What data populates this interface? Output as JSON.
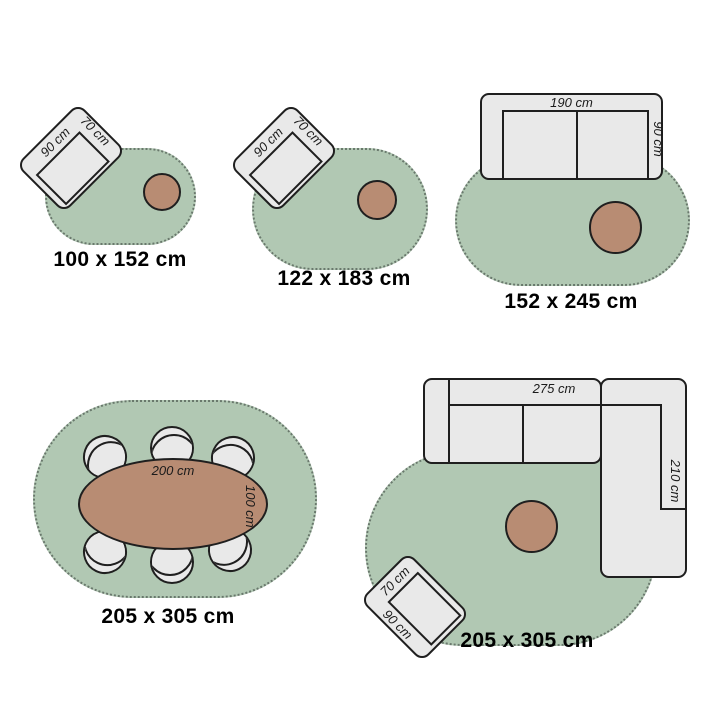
{
  "title": "rug size comparison diagram",
  "colors": {
    "rug": "#b1c8b3",
    "furniture": "#e9e9e9",
    "accent": "#b88c73",
    "outline": "#1f1f1f"
  },
  "scenes": [
    {
      "name": "oval-rug-small",
      "size_label": "100 x 152 cm",
      "chair": {
        "width": "90 cm",
        "depth": "70 cm"
      }
    },
    {
      "name": "oval-rug-medium",
      "size_label": "122 x 183 cm",
      "chair": {
        "width": "90 cm",
        "depth": "70 cm"
      }
    },
    {
      "name": "oval-rug-large",
      "size_label": "152 x 245 cm",
      "sofa": {
        "width": "190 cm",
        "depth": "90 cm"
      }
    },
    {
      "name": "oval-rug-dining",
      "size_label": "205 x 305 cm",
      "table": {
        "length": "200 cm",
        "width": "100 cm"
      },
      "chair_count": 6
    },
    {
      "name": "oval-rug-corner-sofa",
      "size_label": "205 x 305 cm",
      "corner_sofa": {
        "width": "275 cm",
        "depth": "210 cm"
      },
      "chair": {
        "width": "90 cm",
        "depth": "70 cm"
      }
    }
  ]
}
